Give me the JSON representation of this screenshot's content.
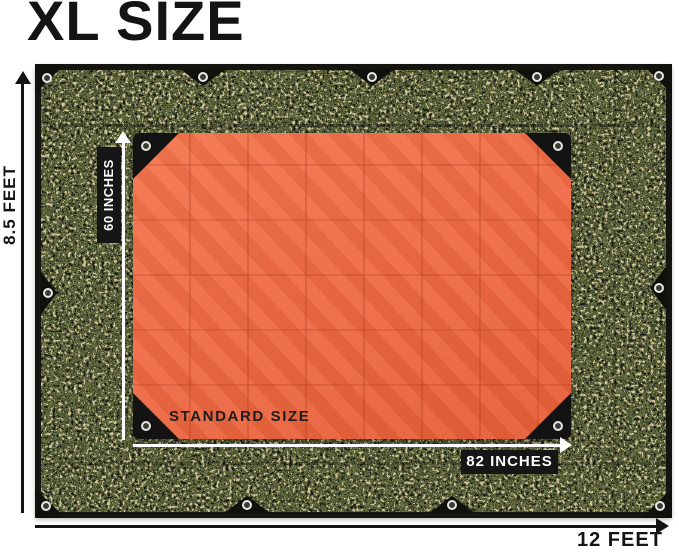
{
  "title": "XL SIZE",
  "xl_tarp": {
    "height_label": "8.5 FEET",
    "width_label": "12 FEET"
  },
  "standard_tarp": {
    "size_label": "STANDARD SIZE",
    "height_label": "60 INCHES",
    "width_label": "82 INCHES"
  },
  "colors": {
    "background": "#ffffff",
    "annotation_text": "#141414",
    "label_pill_bg": "#161616",
    "label_pill_text": "#ffffff",
    "orange_tarp": "#ef6a44",
    "orange_crease": "#d7532f",
    "camo_black": "#23241c",
    "camo_dark_green": "#3f4a2c",
    "camo_olive": "#6e7847",
    "camo_khaki": "#c2b88c",
    "tarp_border": "#141510",
    "grommet_ring": "#e9e9e4"
  },
  "icons": {
    "grommet": "grommet-eyelet",
    "arrow_up": "arrowhead-up",
    "arrow_right": "arrowhead-right"
  }
}
